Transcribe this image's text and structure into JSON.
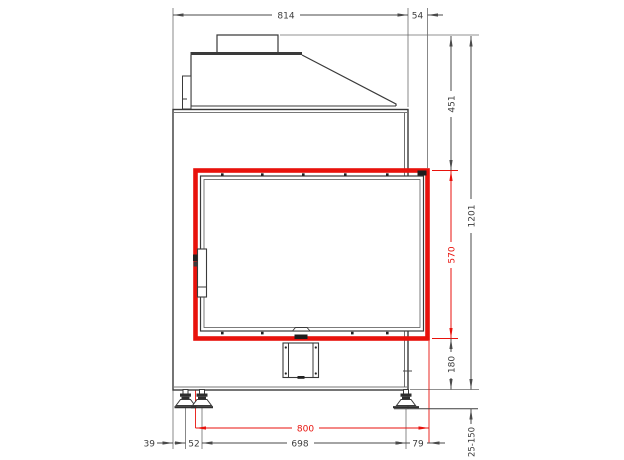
{
  "drawing": {
    "highlight_color": "#e8120c",
    "line_color": "#3f3f3f",
    "dims": {
      "body_width": "814",
      "right_side_offset": "54",
      "upper_section_height": "451",
      "frame_opening_height": "570",
      "lower_section_height": "180",
      "total_height": "1201",
      "foot_height_range": "25-150",
      "left_edge_to_foot": "39",
      "foot_pair_spacing": "52",
      "feet_span": "698",
      "foot_to_frame_edge": "79",
      "frame_width": "800"
    }
  }
}
